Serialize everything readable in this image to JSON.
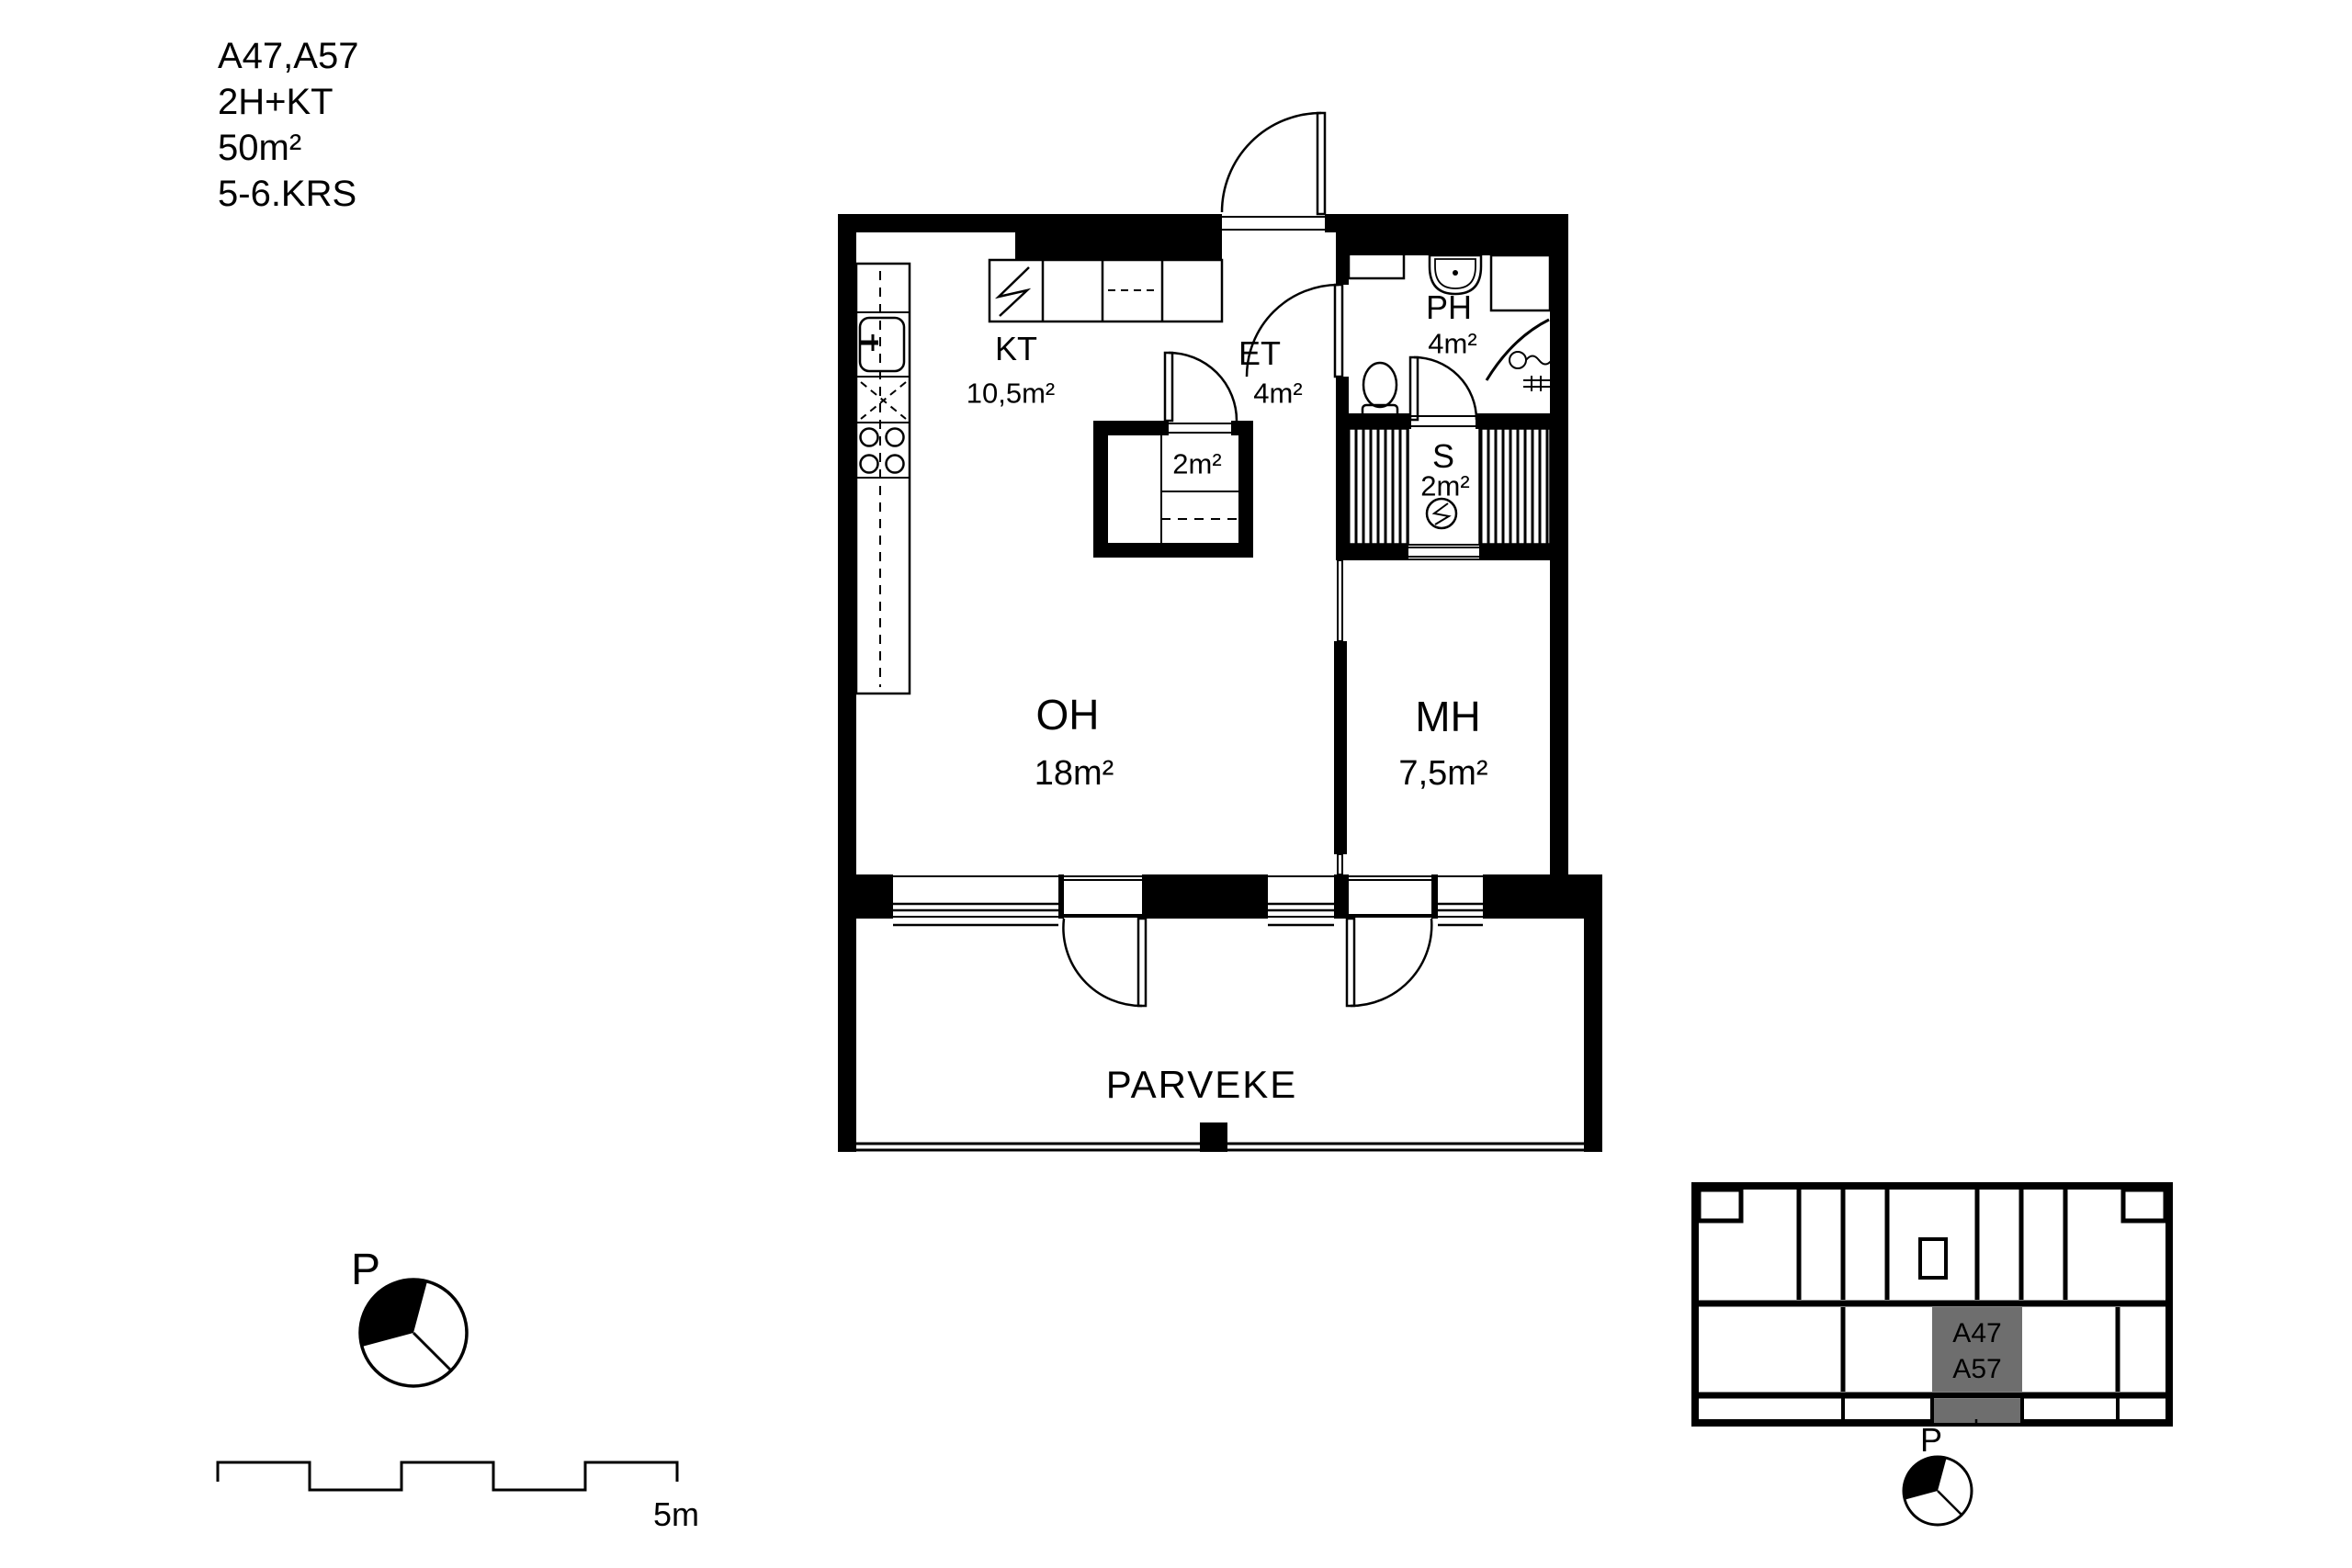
{
  "title": {
    "unit": "A47,A57",
    "layout": "2H+KT",
    "area": "50m²",
    "floors": "5-6.KRS"
  },
  "rooms": {
    "kitchen": {
      "abbr": "KT",
      "area": "10,5m²"
    },
    "entry": {
      "abbr": "ET",
      "area": "4m²"
    },
    "bathroom": {
      "abbr": "PH",
      "area": "4m²"
    },
    "sauna": {
      "abbr": "S",
      "area": "2m²"
    },
    "closet": {
      "area": "2m²"
    },
    "living": {
      "abbr": "OH",
      "area": "18m²"
    },
    "bedroom": {
      "abbr": "MH",
      "area": "7,5m²"
    },
    "balcony": {
      "abbr": "PARVEKE"
    }
  },
  "compass": {
    "label": "P"
  },
  "scalebar": {
    "label": "5m"
  },
  "keyplan": {
    "unit_line1": "A47",
    "unit_line2": "A57",
    "compass_label": "P",
    "highlight_color": "#6e6e6e"
  },
  "colors": {
    "wall": "#000000",
    "background": "#ffffff"
  }
}
